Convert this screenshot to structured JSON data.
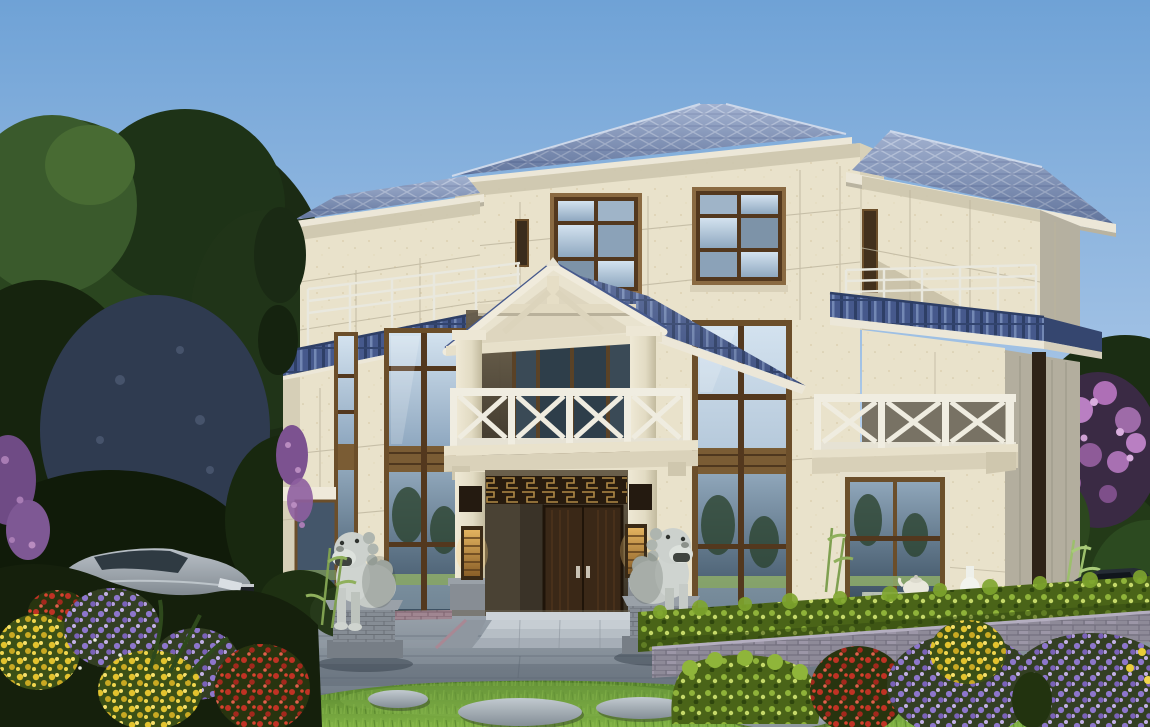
{
  "scene": {
    "kind": "architectural-exterior-render",
    "subject": "three-story chinese-style villa with blue tiled hip roofs",
    "time": "daytime, clear sky",
    "view": "frontal elevation with garden foreground"
  },
  "building": {
    "floors": 3,
    "roof_style": "hip roof, blue glazed tile, cream fascia",
    "facade": "cream stone panels with joint lines",
    "skirt_roof": "blue tile pent band between 2nd and 3rd floor",
    "terrace_railing_floor3": "white pipe rail",
    "balcony_railing_floor2": "white X-lattice panels",
    "porch": "gabled tile roof with cream truss pediment and two columns",
    "entrance": {
      "doors": 2,
      "door_material": "dark walnut double door",
      "fretwork": "gold chinese lattice transom",
      "lanterns": 2,
      "guardian_lions": 2,
      "steps": 3
    },
    "windows": "dark brown aluminium frames, two-story curtain glazing flanking porch"
  },
  "garden": {
    "lawn": true,
    "stepping_stones": 5,
    "hedge": "clipped yellow-green hedge over grey brick planter wall",
    "stone_tea_table": true,
    "flower_colors": [
      "purple",
      "yellow",
      "red",
      "pink blossom"
    ],
    "trees": "dense dark green trees left, pink blossom tree right",
    "vehicles": [
      "silver sedan left",
      "dark sedan right"
    ]
  },
  "palette": {
    "sky_top": "#6FA2D6",
    "sky_mid": "#A2C2E5",
    "sky_horizon": "#E2EEF8",
    "roof_tile_base": "#7E93BD",
    "roof_tile_line": "#AAB9D7",
    "skirt_tile": "#46598C",
    "fascia_cream": "#ECE7D8",
    "wall_cream": "#E9E2CB",
    "wall_shadow": "#CDC6AE",
    "wall_side": "#B5B0A0",
    "window_frame": "#6B4E2A",
    "window_frame_dark": "#53381E",
    "glass_light": "#D3E2EF",
    "glass_deep": "#3C5062",
    "railing_white": "#F0EDE1",
    "door_brown": "#3A2817",
    "fret_gold": "#B08A46",
    "lantern_glow": "#E3B35F",
    "lion_stone": "#CCD1CD",
    "paving_light": "#97A0A9",
    "paving_dark": "#6B7681",
    "lawn_dark": "#55822D",
    "lawn_light": "#7FB044",
    "hedge_base": "#4A6418",
    "brick_wall": "#8E8A98",
    "flower_purple": "#8D76CC",
    "flower_yellow": "#E3C32E",
    "flower_red": "#C03224",
    "blossom_pink": "#B97FC2",
    "car_silver": "#8F979E",
    "car_dark": "#252C34",
    "stone_gray": "#A8B0B6"
  }
}
